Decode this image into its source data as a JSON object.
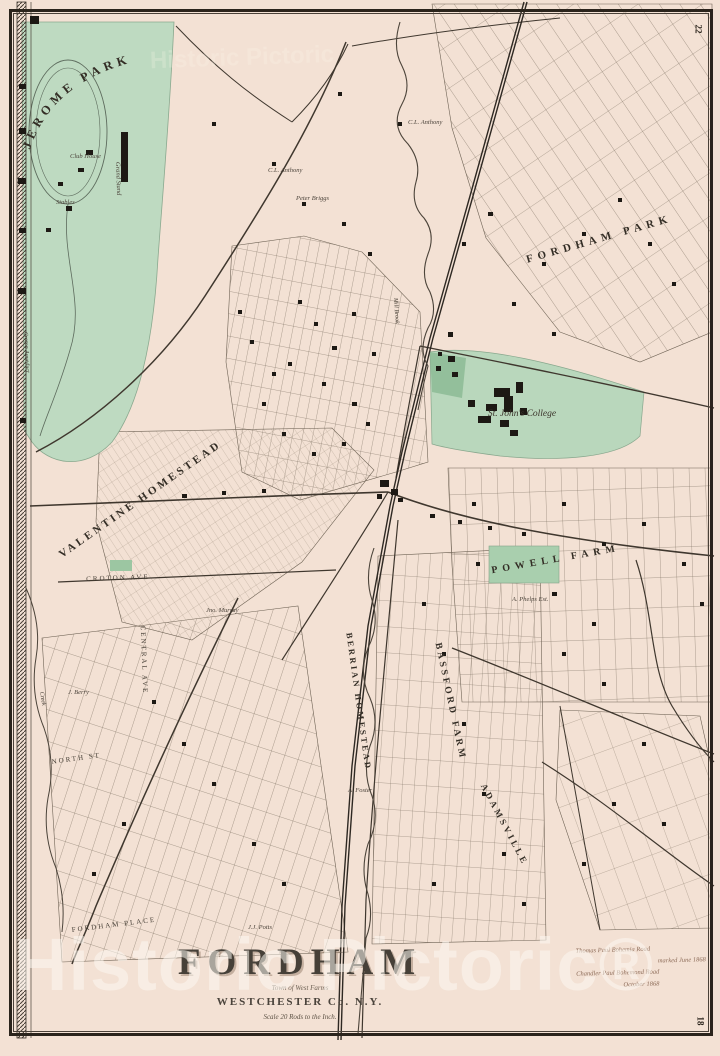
{
  "page_numbers": {
    "top_right": "22",
    "bottom_right": "18"
  },
  "watermark": {
    "text": "Historic Pictoric®",
    "ghost_text": "Historic Pictoric"
  },
  "title_block": {
    "title": "FORDHAM",
    "subtitle": "Town of West Farms",
    "county": "WESTCHESTER Co. N.Y.",
    "scale_note": "Scale 20 Rods to the Inch."
  },
  "handwritten_note": {
    "line1": "Thomas Paul Bohemia Road",
    "line2": "marked June 1868",
    "line3": "Chandler Paul Bohemond Road",
    "line4": "October 1868"
  },
  "map_labels": {
    "jerome_park": "JEROME PARK",
    "fordham_park": "FORDHAM  PARK",
    "st_johns_college": "St. John's College",
    "valentine_homestead": "VALENTINE HOMESTEAD",
    "powell_farm": "POWELL FARM",
    "bassford_farm": "BASSFORD FARM",
    "berrian_homestead": "BERRIAN HOMESTEAD",
    "adamsville": "ADAMSVILLE",
    "central_ave": "CENTRAL AVE",
    "croton_ave": "CROTON AVE",
    "north_st": "NORTH ST",
    "fordham_place": "FORDHAM PLACE",
    "croton_aqueduct": "Croton Aqueduct",
    "mill_brook": "Mill Brook",
    "creek": "Creek",
    "club_house": "Club House",
    "grand_stand": "Grand Stand",
    "stables": "Stables"
  },
  "owner_labels": {
    "anthony1": "C.L. Anthony",
    "anthony2": "C.L. Anthony",
    "peter_briggs": "Peter Briggs",
    "jno_murray": "Jno. Murray",
    "phelps": "A. Phelps Est.",
    "foster": "A. Foster",
    "potts": "J.J. Potts",
    "berry": "J. Berry"
  },
  "colors": {
    "paper": "#f3e1d4",
    "park_green": "#bedac1",
    "college_green": "#b9d7bc",
    "ink": "#3a332b",
    "frame": "#2b241c",
    "watermark": "rgba(252,248,242,0.55)"
  }
}
